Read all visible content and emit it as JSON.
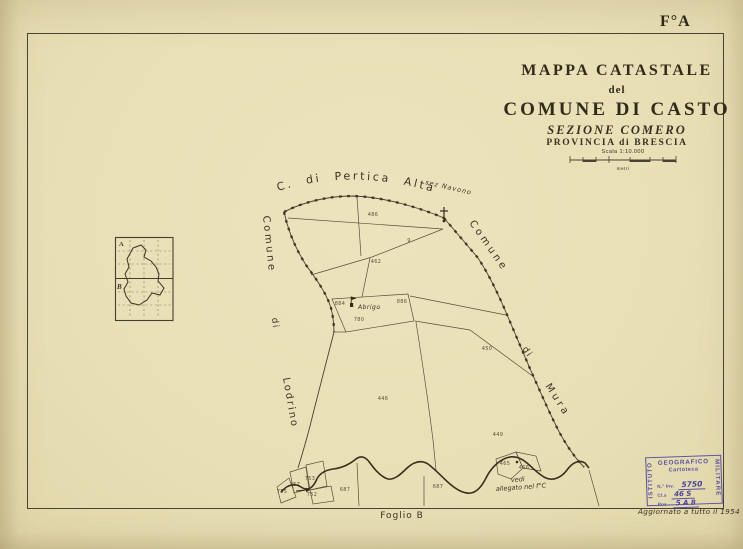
{
  "page": {
    "sheet_label": "F°A",
    "bottom_sheet_label": "Foglio B",
    "update_note": "Aggiornato a tutto il 1954"
  },
  "title_block": {
    "line1": "MAPPA CATASTALE",
    "line2": "del",
    "line3": "COMUNE DI CASTO",
    "line4": "SEZIONE COMERO",
    "line5": "PROVINCIA di BRESCIA",
    "scale_label": "Scala 1:10.000",
    "scale_unit": "metri"
  },
  "inset": {
    "label_a": "A",
    "label_b": "B"
  },
  "map_labels": {
    "north_neighbor": "C. di Pertica Alta",
    "north_neighbor_sub": "sez Navono",
    "west_neighbor": [
      "Comune",
      "di",
      "Lodrino"
    ],
    "east_neighbor": [
      "Comune",
      "di",
      "Mura"
    ],
    "hamlet": "Abrigo",
    "attachment_note_line1": "vedi",
    "attachment_note_line2": "allegato nel f°C"
  },
  "parcels": [
    {
      "x": 373,
      "y": 215,
      "n": "486"
    },
    {
      "x": 409,
      "y": 241,
      "n": "9"
    },
    {
      "x": 376,
      "y": 262,
      "n": "462"
    },
    {
      "x": 340,
      "y": 304,
      "n": "884"
    },
    {
      "x": 402,
      "y": 302,
      "n": "886"
    },
    {
      "x": 359,
      "y": 320,
      "n": "780"
    },
    {
      "x": 487,
      "y": 349,
      "n": "450"
    },
    {
      "x": 383,
      "y": 399,
      "n": "446"
    },
    {
      "x": 498,
      "y": 435,
      "n": "449"
    },
    {
      "x": 345,
      "y": 490,
      "n": "687"
    },
    {
      "x": 310,
      "y": 479,
      "n": "753"
    },
    {
      "x": 295,
      "y": 485,
      "n": "757"
    },
    {
      "x": 282,
      "y": 492,
      "n": "755"
    },
    {
      "x": 312,
      "y": 495,
      "n": "752"
    },
    {
      "x": 438,
      "y": 487,
      "n": "687"
    },
    {
      "x": 505,
      "y": 464,
      "n": "465"
    },
    {
      "x": 524,
      "y": 468,
      "n": "466"
    }
  ],
  "stamp": {
    "org_left": "ISTITUTO",
    "org_top": "GEOGRAFICO",
    "org_right": "MILITARE",
    "line1": "Cartoteca",
    "inv_label": "N.° Inv.",
    "inv_value": "5750",
    "cl_label": "Cl.s",
    "cl_value": "46 S",
    "pos_label": "Pos.",
    "pos_value": "5 A 8"
  },
  "colors": {
    "paper": "#e8dfb6",
    "ink": "#3b3325",
    "stamp": "#5b4fa3"
  }
}
